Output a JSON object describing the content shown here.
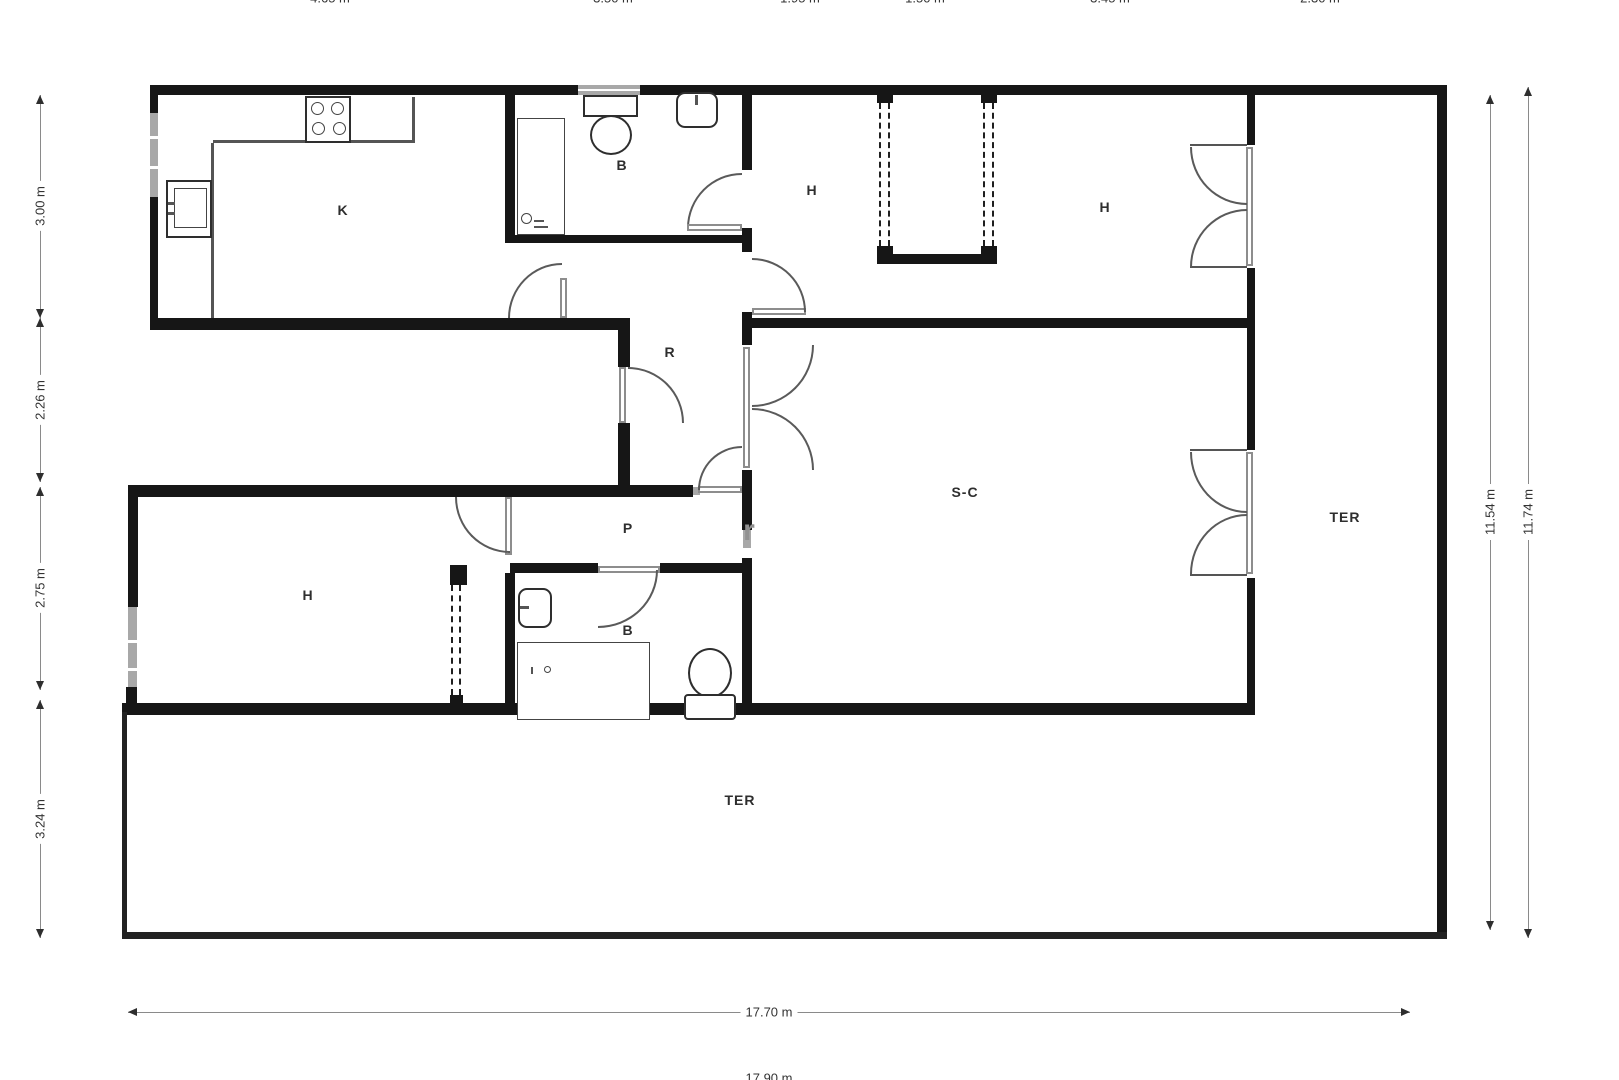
{
  "plan": {
    "rooms": {
      "kitchen": "K",
      "bath_top": "B",
      "bed_top": "H",
      "bed_top_right": "H",
      "hall": "R",
      "living_dining": "S-C",
      "terrace_right": "TER",
      "passage": "P",
      "bed_bottom": "H",
      "bath_bottom": "B",
      "terrace_bottom": "TER"
    },
    "dims": {
      "top": [
        "4.65 m",
        "3.50 m",
        "1.95 m",
        "1.50 m",
        "3.45 m",
        "2.30 m"
      ],
      "left": [
        "3.00 m",
        "2.26 m",
        "2.75 m",
        "3.24 m"
      ],
      "right": [
        "11.54 m",
        "11.74 m"
      ],
      "bottom": [
        "17.70 m",
        "17.90 m"
      ]
    },
    "watermark": "r",
    "colors": {
      "wall": "#161616",
      "window": "#a8a8a8",
      "doorline": "#5a5a5a",
      "dimtext": "#333333"
    }
  }
}
